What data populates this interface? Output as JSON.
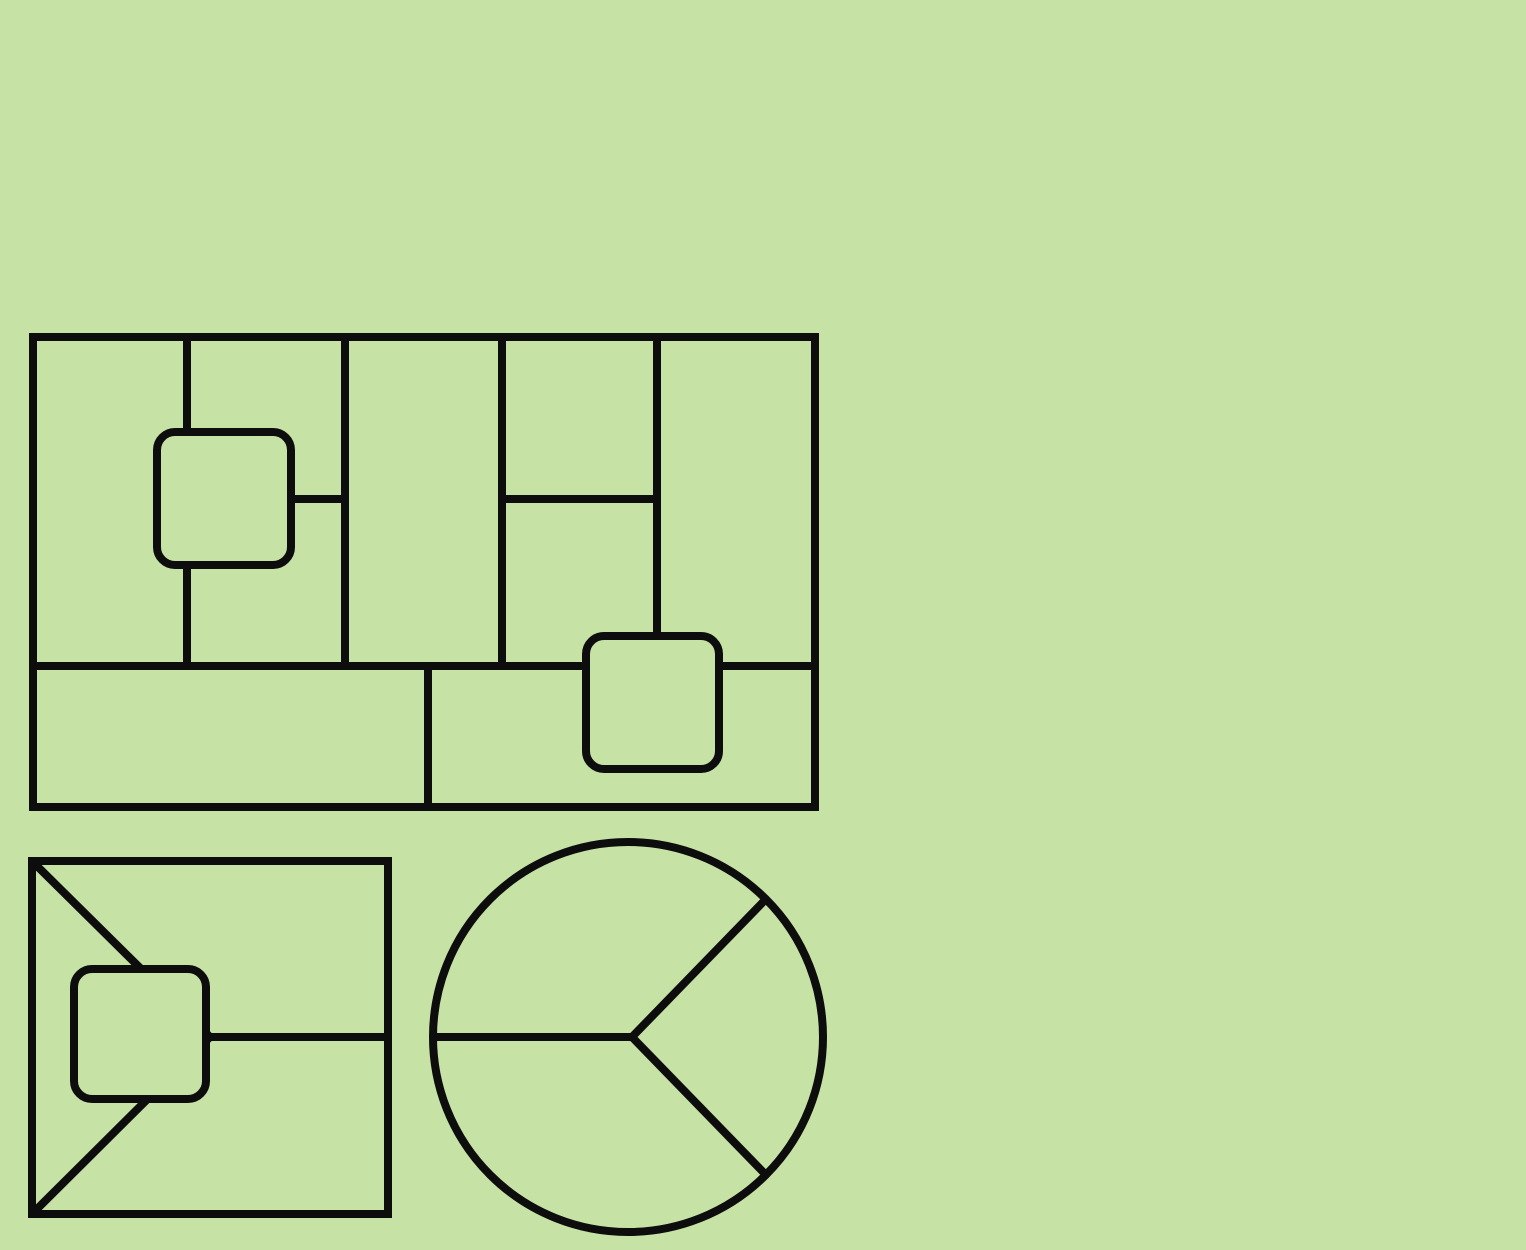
{
  "canvas": {
    "width": 1526,
    "height": 1250,
    "background_color": "#c6e2a5",
    "line_color": "#0d0d0d",
    "line_width": 8,
    "node_corner_radius": 18
  },
  "figures": [
    {
      "name": "partitioned-rectangle-figure",
      "shapes": [
        {
          "type": "rect",
          "name": "grid-outer-rect",
          "x": 33,
          "y": 337,
          "w": 782,
          "h": 470
        },
        {
          "type": "line",
          "name": "grid-vline-1",
          "x1": 187,
          "y1": 337,
          "x2": 187,
          "y2": 666
        },
        {
          "type": "line",
          "name": "grid-vline-2",
          "x1": 345,
          "y1": 337,
          "x2": 345,
          "y2": 666
        },
        {
          "type": "line",
          "name": "grid-vline-3",
          "x1": 502,
          "y1": 337,
          "x2": 502,
          "y2": 666
        },
        {
          "type": "line",
          "name": "grid-vline-4",
          "x1": 657,
          "y1": 337,
          "x2": 657,
          "y2": 666
        },
        {
          "type": "line",
          "name": "grid-strip-hline",
          "x1": 33,
          "y1": 666,
          "x2": 815,
          "y2": 666
        },
        {
          "type": "line",
          "name": "grid-strip-divider",
          "x1": 428,
          "y1": 666,
          "x2": 428,
          "y2": 807
        },
        {
          "type": "line",
          "name": "grid-connector-left",
          "x1": 224,
          "y1": 499,
          "x2": 345,
          "y2": 499
        },
        {
          "type": "line",
          "name": "grid-connector-right",
          "x1": 502,
          "y1": 499,
          "x2": 657,
          "y2": 499
        },
        {
          "type": "roundrect",
          "name": "grid-node-square-1",
          "x": 157,
          "y": 432,
          "w": 134,
          "h": 133
        },
        {
          "type": "roundrect",
          "name": "grid-node-square-2",
          "x": 586,
          "y": 636,
          "w": 133,
          "h": 133
        }
      ]
    },
    {
      "name": "envelope-rectangle-figure",
      "shapes": [
        {
          "type": "rect",
          "name": "envelope-outer-rect",
          "x": 32,
          "y": 861,
          "w": 356,
          "h": 353
        },
        {
          "type": "line",
          "name": "envelope-top-diagonal",
          "x1": 36,
          "y1": 865,
          "x2": 210,
          "y2": 1037
        },
        {
          "type": "line",
          "name": "envelope-bottom-diagonal",
          "x1": 36,
          "y1": 1210,
          "x2": 210,
          "y2": 1037
        },
        {
          "type": "line",
          "name": "envelope-center-hline",
          "x1": 206,
          "y1": 1037,
          "x2": 388,
          "y2": 1037
        },
        {
          "type": "roundrect",
          "name": "envelope-node-square",
          "x": 74,
          "y": 969,
          "w": 132,
          "h": 130
        }
      ]
    },
    {
      "name": "segmented-circle-figure",
      "shapes": [
        {
          "type": "circle",
          "name": "pie-circle",
          "cx": 628,
          "cy": 1037,
          "r": 195
        },
        {
          "type": "line",
          "name": "pie-left-radius",
          "x1": 433,
          "y1": 1037,
          "x2": 634,
          "y2": 1037
        },
        {
          "type": "polyline",
          "name": "pie-diagonal-radii",
          "points": "766,899 632,1037 766,1175"
        }
      ]
    }
  ]
}
